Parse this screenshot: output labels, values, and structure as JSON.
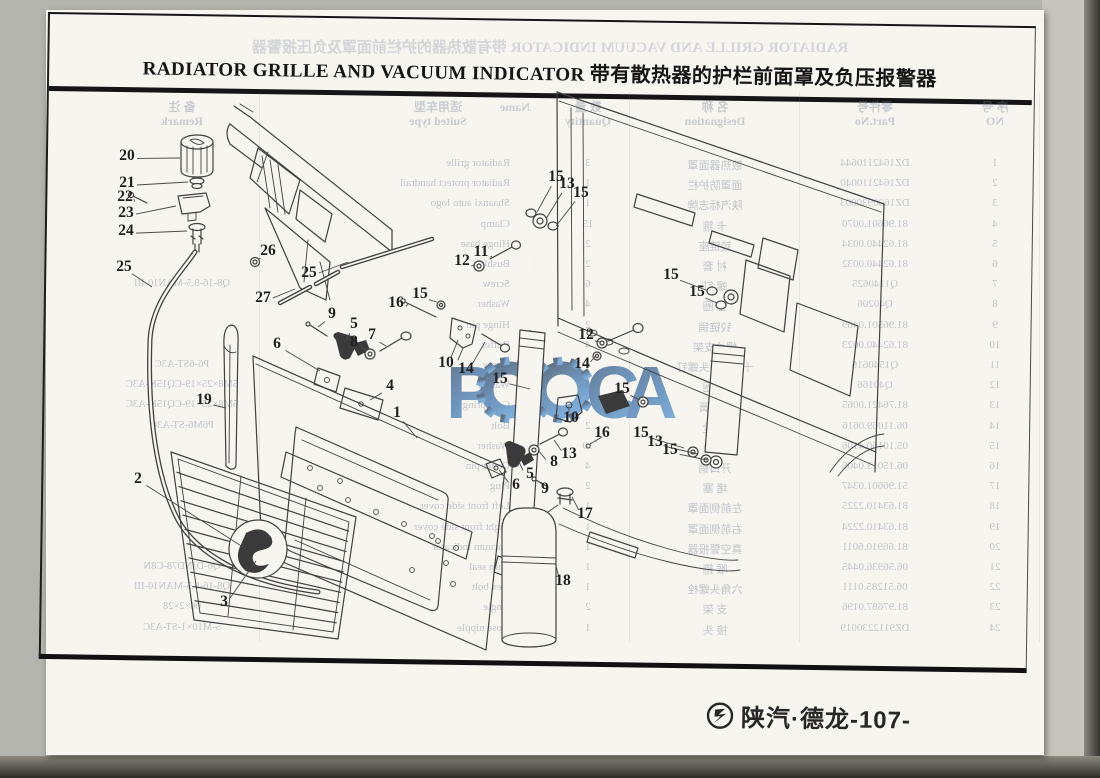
{
  "document": {
    "title_en": "RADIATOR GRILLE AND VACUUM INDICATOR",
    "title_zh": "带有散热器的护栏前面罩及负压报警器",
    "watermark_text": "РОССА",
    "footer": {
      "brand": "陕汽·德龙",
      "page": "-107-"
    }
  },
  "colors": {
    "paper": "#f7f5ef",
    "ink": "#414141",
    "background": "#b4b5ae",
    "scan_edge": "#2e2d28",
    "ghost_text": "#6e7d96",
    "watermark_top": "#4d6178",
    "watermark_bottom": "#6ca3d4"
  },
  "callouts": [
    {
      "n": "20",
      "x": 127,
      "y": 155,
      "tx": 180,
      "ty": 158
    },
    {
      "n": "21",
      "x": 127,
      "y": 182,
      "tx": 188,
      "ty": 182
    },
    {
      "n": "22",
      "x": 125,
      "y": 196,
      "tx": 134,
      "ty": 199
    },
    {
      "n": "23",
      "x": 126,
      "y": 212,
      "tx": 176,
      "ty": 206
    },
    {
      "n": "24",
      "x": 126,
      "y": 230,
      "tx": 187,
      "ty": 231
    },
    {
      "n": "25",
      "x": 124,
      "y": 266,
      "tx": 152,
      "ty": 287
    },
    {
      "n": "26",
      "x": 268,
      "y": 250,
      "tx": 258,
      "ty": 259
    },
    {
      "n": "27",
      "x": 263,
      "y": 297,
      "tx": 295,
      "ty": 289
    },
    {
      "n": "25",
      "x": 309,
      "y": 272,
      "tx": 348,
      "ty": 262
    },
    {
      "n": "19",
      "x": 204,
      "y": 399,
      "tx": 226,
      "ty": 408
    },
    {
      "n": "9",
      "x": 332,
      "y": 313,
      "tx": 318,
      "ty": 327
    },
    {
      "n": "5",
      "x": 354,
      "y": 323,
      "tx": 346,
      "ty": 340
    },
    {
      "n": "7",
      "x": 372,
      "y": 334,
      "tx": 386,
      "ty": 346
    },
    {
      "n": "8",
      "x": 354,
      "y": 341,
      "tx": 366,
      "ty": 350
    },
    {
      "n": "6",
      "x": 277,
      "y": 343,
      "tx": 320,
      "ty": 371
    },
    {
      "n": "4",
      "x": 390,
      "y": 385,
      "tx": 370,
      "ty": 400
    },
    {
      "n": "1",
      "x": 397,
      "y": 412,
      "tx": 417,
      "ty": 438
    },
    {
      "n": "2",
      "x": 138,
      "y": 478,
      "tx": 246,
      "ty": 549
    },
    {
      "n": "3",
      "x": 224,
      "y": 601,
      "tx": 256,
      "ty": 561
    },
    {
      "n": "16",
      "x": 396,
      "y": 302,
      "tx": 408,
      "ty": 304
    },
    {
      "n": "15",
      "x": 420,
      "y": 293,
      "tx": 437,
      "ty": 302
    },
    {
      "n": "12",
      "x": 462,
      "y": 260,
      "tx": 475,
      "ty": 265
    },
    {
      "n": "11",
      "x": 481,
      "y": 251,
      "tx": 492,
      "ty": 256
    },
    {
      "n": "10",
      "x": 446,
      "y": 362,
      "tx": 458,
      "ty": 340
    },
    {
      "n": "14",
      "x": 466,
      "y": 368,
      "tx": 485,
      "ty": 342
    },
    {
      "n": "15",
      "x": 500,
      "y": 378,
      "tx": 530,
      "ty": 389
    },
    {
      "n": "15",
      "x": 556,
      "y": 176,
      "tx": 537,
      "ty": 212
    },
    {
      "n": "13",
      "x": 567,
      "y": 183,
      "tx": 546,
      "ty": 219
    },
    {
      "n": "15",
      "x": 581,
      "y": 192,
      "tx": 556,
      "ty": 226
    },
    {
      "n": "12",
      "x": 586,
      "y": 334,
      "tx": 600,
      "ty": 342
    },
    {
      "n": "14",
      "x": 582,
      "y": 363,
      "tx": 597,
      "ty": 354
    },
    {
      "n": "15",
      "x": 622,
      "y": 388,
      "tx": 640,
      "ty": 400
    },
    {
      "n": "10",
      "x": 571,
      "y": 417,
      "tx": 569,
      "ty": 407
    },
    {
      "n": "16",
      "x": 602,
      "y": 432,
      "tx": 596,
      "ty": 441
    },
    {
      "n": "13",
      "x": 569,
      "y": 453,
      "tx": 554,
      "ty": 440
    },
    {
      "n": "8",
      "x": 554,
      "y": 461,
      "tx": 538,
      "ty": 450
    },
    {
      "n": "5",
      "x": 530,
      "y": 473,
      "tx": 519,
      "ty": 462
    },
    {
      "n": "9",
      "x": 545,
      "y": 488,
      "tx": 542,
      "ty": 482
    },
    {
      "n": "6",
      "x": 516,
      "y": 484,
      "tx": 499,
      "ty": 470
    },
    {
      "n": "17",
      "x": 585,
      "y": 513,
      "tx": 572,
      "ty": 497
    },
    {
      "n": "18",
      "x": 563,
      "y": 580,
      "tx": 556,
      "ty": 566
    },
    {
      "n": "15",
      "x": 671,
      "y": 274,
      "tx": 706,
      "ty": 290
    },
    {
      "n": "15",
      "x": 697,
      "y": 291,
      "tx": 717,
      "ty": 303
    },
    {
      "n": "15",
      "x": 641,
      "y": 432,
      "tx": 684,
      "ty": 448
    },
    {
      "n": "13",
      "x": 655,
      "y": 441,
      "tx": 698,
      "ty": 454
    },
    {
      "n": "15",
      "x": 670,
      "y": 449,
      "tx": 707,
      "ty": 460
    }
  ],
  "ghost": {
    "title": "RADIATOR GRILLE AND VACUUM INDICATOR  带有散热器的护栏前面罩及负压报警器",
    "headers": [
      {
        "x": 105,
        "zh": "序 号",
        "en": "NO"
      },
      {
        "x": 225,
        "zh": "零件号",
        "en": "Part.No"
      },
      {
        "x": 385,
        "zh": "名 称",
        "en": "Designation"
      },
      {
        "x": 512,
        "zh": "数 量",
        "en": "Quantity"
      },
      {
        "x": 585,
        "zh": "",
        "en": "Name"
      },
      {
        "x": 662,
        "zh": "适用车型",
        "en": "Suited type"
      },
      {
        "x": 918,
        "zh": "备 注",
        "en": "Remark"
      }
    ],
    "rows": [
      {
        "no": "1",
        "part": "DZ1642110644",
        "zh": "散热器面罩",
        "qty": "3",
        "en": "Radiator grille"
      },
      {
        "no": "2",
        "part": "DZ1642110040",
        "zh": "面罩防护栏",
        "qty": "1",
        "en": "Radiator protect handrail"
      },
      {
        "no": "3",
        "part": "DZ1600930003",
        "zh": "陕汽标志牌",
        "qty": "1",
        "en": "Shaanxi auto logo"
      },
      {
        "no": "4",
        "part": "81.96601.0070",
        "zh": "卡 箍",
        "qty": "15",
        "en": "Clamp"
      },
      {
        "no": "5",
        "part": "81.62440.0034",
        "zh": "铰链座",
        "qty": "2",
        "en": "Hinge base"
      },
      {
        "no": "6",
        "part": "81.62440.0032",
        "zh": "衬 套",
        "qty": "2",
        "en": "Bushing"
      },
      {
        "no": "7",
        "part": "Q1140625",
        "zh": "螺 钉",
        "qty": "6",
        "en": "Screw"
      },
      {
        "no": "8",
        "part": "Q40206",
        "zh": "垫 圈",
        "qty": "4",
        "en": "Washer"
      },
      {
        "no": "9",
        "part": "81.96501.0469",
        "zh": "铰链销",
        "qty": "2",
        "en": "Hinge pin"
      },
      {
        "no": "10",
        "part": "81.62440.0023",
        "zh": "缓冲支架",
        "qty": "4",
        "en": "Buffer"
      },
      {
        "no": "11",
        "part": "Q1540616",
        "zh": "十字槽盘头螺钉",
        "qty": "4",
        "en": "Screw"
      },
      {
        "no": "12",
        "part": "Q40166",
        "zh": "垫 圈",
        "qty": "4",
        "en": "Washer"
      },
      {
        "no": "13",
        "part": "81.76421.0065",
        "zh": "气弹簧",
        "qty": "2",
        "en": "Gas spring"
      },
      {
        "no": "14",
        "part": "06.11069.0616",
        "zh": "螺 栓",
        "qty": "2",
        "en": "Bolt"
      },
      {
        "no": "15",
        "part": "05.10160.4106",
        "zh": "垫 片",
        "qty": "10",
        "en": "Washer"
      },
      {
        "no": "16",
        "part": "06.15013.0406",
        "zh": "开口销",
        "qty": "4",
        "en": "Cotter pin"
      },
      {
        "no": "17",
        "part": "51.96601.0347",
        "zh": "堵 塞",
        "qty": "2",
        "en": "Plug"
      },
      {
        "no": "18",
        "part": "81.63410.2225",
        "zh": "左前侧面罩",
        "qty": "1",
        "en": "Left front side cover"
      },
      {
        "no": "19",
        "part": "81.63410.2224",
        "zh": "右前侧面罩",
        "qty": "1",
        "en": "Right front side cover"
      },
      {
        "no": "20",
        "part": "81.66910.6011",
        "zh": "真空警报器",
        "qty": "1",
        "en": "Vacuum indicator"
      },
      {
        "no": "21",
        "part": "06.56936.0445",
        "zh": "喉 箍",
        "qty": "1",
        "en": "Turn seal"
      },
      {
        "no": "22",
        "part": "06.51285.0111",
        "zh": "六角头螺栓",
        "qty": "1",
        "en": "Hex bolt"
      },
      {
        "no": "23",
        "part": "81.97687.0196",
        "zh": "支 架",
        "qty": "2",
        "en": "Angle"
      },
      {
        "no": "24",
        "part": "DZ9112230019",
        "zh": "接 头",
        "qty": "1",
        "en": "Hose nipple"
      }
    ],
    "remarks": [
      {
        "row": 7,
        "text": "Q8-16-8.5-MAN10-III"
      },
      {
        "row": 11,
        "text": "P6-6ST-A3C"
      },
      {
        "row": 12,
        "text": "5M8×25×19-CQ15K-A3C"
      },
      {
        "row": 13,
        "text": "5M8×25×19-CQ15K-A3C"
      },
      {
        "row": 14,
        "text": "P6M6-ST-A3C"
      },
      {
        "row": 21,
        "text": "Q6-DJND78-C8N"
      },
      {
        "row": 22,
        "text": "Q8-16-8.5-MAN10-III"
      },
      {
        "row": 23,
        "text": "06×2×28"
      },
      {
        "row": 24,
        "text": "5-M10×1-ST-A3C"
      }
    ]
  }
}
